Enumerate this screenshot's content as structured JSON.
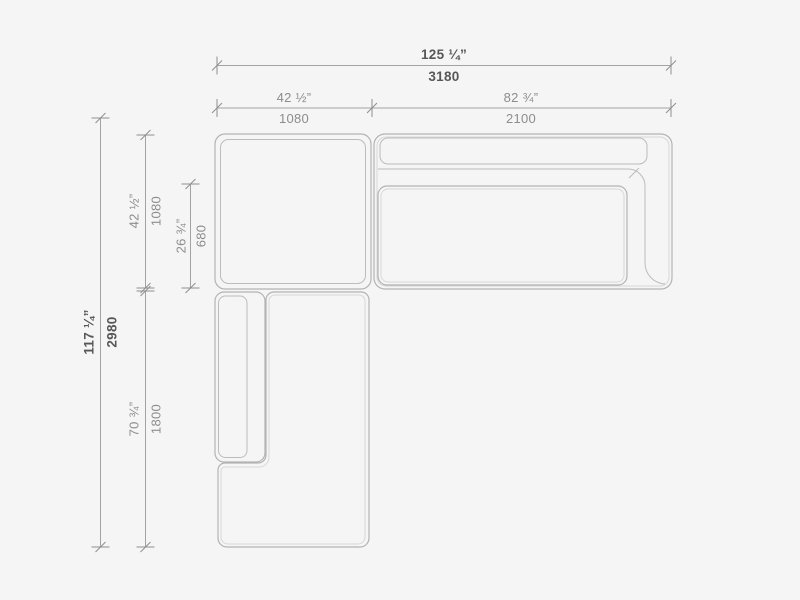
{
  "drawing": {
    "name": "sectional-sofa-plan-dimension-drawing",
    "background_color": "#f5f5f5",
    "outline_color": "#b3b3b3",
    "dimension_line_color": "#a3a3a3",
    "dimension_text_color": "#8d8d8d",
    "overall_dimension_text_color": "#575757"
  },
  "dimensions": {
    "overall_width": {
      "inches": "125 ¼”",
      "mm": "3180"
    },
    "left_module_width": {
      "inches": "42 ½”",
      "mm": "1080"
    },
    "right_module_width": {
      "inches": "82 ¾”",
      "mm": "2100"
    },
    "overall_depth": {
      "inches": "117 ¼”",
      "mm": "2980"
    },
    "top_module_depth": {
      "inches": "42 ½”",
      "mm": "1080"
    },
    "seat_depth": {
      "inches": "26 ¾”",
      "mm": "680"
    },
    "chaise_length": {
      "inches": "70 ¾”",
      "mm": "1800"
    }
  }
}
